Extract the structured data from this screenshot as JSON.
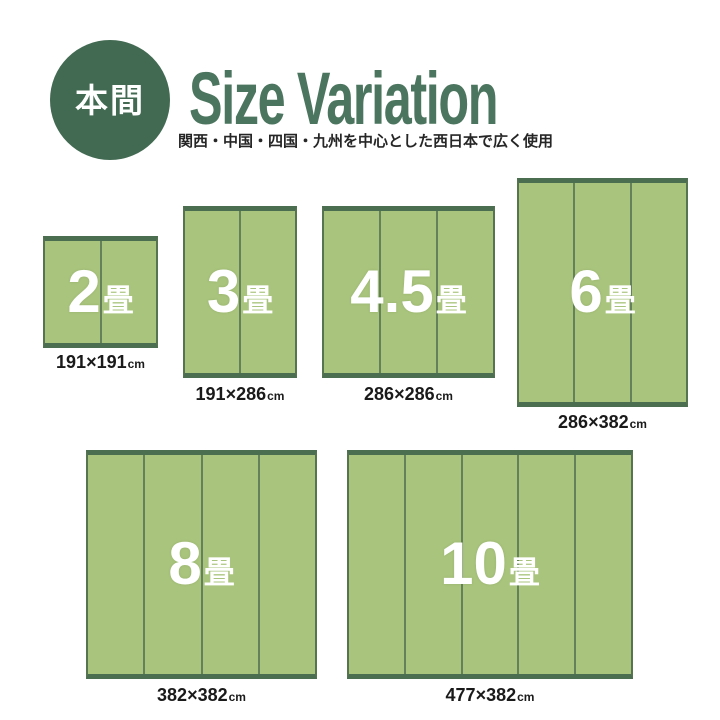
{
  "header": {
    "badge_label": "本間",
    "title": "Size Variation",
    "subtitle": "関西・中国・四国・九州を中心とした西日本で広く使用"
  },
  "colors": {
    "badge_green": "#426a52",
    "title_green": "#4b755e",
    "mat_fill": "#a9c47c",
    "mat_edge": "#4c6e50",
    "mat_divider": "#64815b",
    "caption_text": "#1a1a1a"
  },
  "mats": [
    {
      "label_number": "2",
      "label_unit": "畳",
      "dimensions": "191×191",
      "unit": "cm",
      "panels": 2
    },
    {
      "label_number": "3",
      "label_unit": "畳",
      "dimensions": "191×286",
      "unit": "cm",
      "panels": 2
    },
    {
      "label_number": "4.5",
      "label_unit": "畳",
      "dimensions": "286×286",
      "unit": "cm",
      "panels": 3
    },
    {
      "label_number": "6",
      "label_unit": "畳",
      "dimensions": "286×382",
      "unit": "cm",
      "panels": 3
    },
    {
      "label_number": "8",
      "label_unit": "畳",
      "dimensions": "382×382",
      "unit": "cm",
      "panels": 4
    },
    {
      "label_number": "10",
      "label_unit": "畳",
      "dimensions": "477×382",
      "unit": "cm",
      "panels": 5
    }
  ]
}
